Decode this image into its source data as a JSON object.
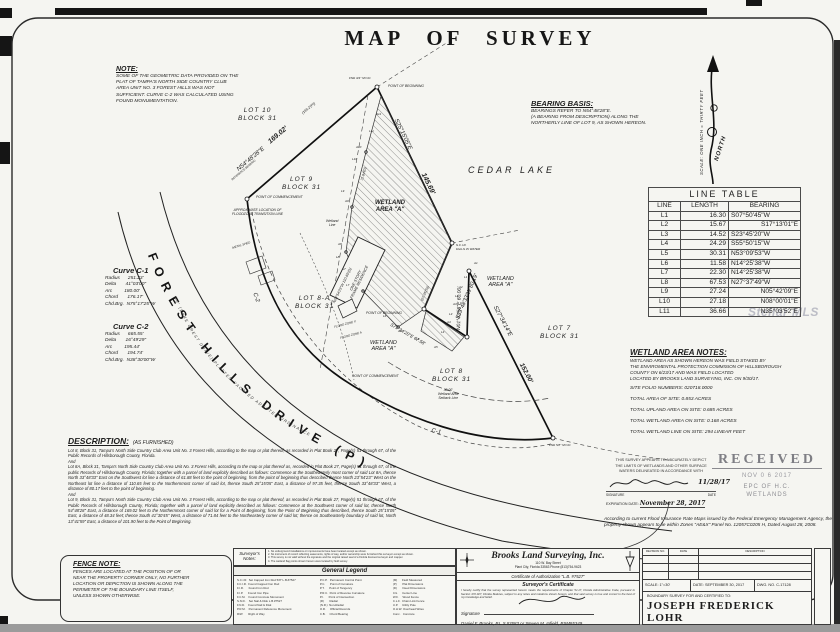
{
  "title": "MAP OF SURVEY",
  "watermark": "Stellar MLS",
  "note": {
    "heading": "NOTE:",
    "body": "SOME OF THE GEOMETRIC DATA PROVIDED ON THE\nPLAT OF TAMPA'S NORTH SIDE COUNTRY CLUB\nAREA UNIT NO. 3 FOREST HILLS WAS NOT\nSUFFICIENT. CURVE C-2 WAS CALCULATED USING\nFOUND MONUMENTATION."
  },
  "bearing_basis": {
    "heading": "BEARING BASIS:",
    "body": "BEARINGS REFER TO N54°48'28\"E.\n(A BEARING FROM DESCRIPTION) ALONG THE\nNORTHERLY LINE OF LOT 9, AS SHOWN HEREON."
  },
  "north": {
    "label": "NORTH",
    "scale": "SCALE: ONE INCH = THIRTY FEET"
  },
  "line_table": {
    "title": "LINE TABLE",
    "headers": [
      "LINE",
      "LENGTH",
      "BEARING"
    ],
    "rows": [
      [
        "L1",
        "16.30",
        "S07°50'45\"W"
      ],
      [
        "L2",
        "15.67",
        "S17°13'01\"E"
      ],
      [
        "L3",
        "14.52",
        "S23°45'20\"W"
      ],
      [
        "L4",
        "24.29",
        "S55°50'15\"W"
      ],
      [
        "L5",
        "30.31",
        "N53°09'53\"W"
      ],
      [
        "L6",
        "11.58",
        "N14°25'38\"W"
      ],
      [
        "L7",
        "22.30",
        "N14°25'38\"W"
      ],
      [
        "L8",
        "67.53",
        "N27°37'49\"W"
      ],
      [
        "L9",
        "27.24",
        "N05°42'09\"E"
      ],
      [
        "L10",
        "27.18",
        "N08°00'01\"E"
      ],
      [
        "L11",
        "36.66",
        "N35°03'52\"E"
      ]
    ]
  },
  "curves": [
    {
      "title": "Curve   C-1",
      "body": "Radius      251.23'\nDelta       41°03'00\"\nArc         180.00'\nChord       176.17'\nChd.Brg.  N75°17'25\"W"
    },
    {
      "title": "Curve   C-2",
      "body": "Radius      665.55'\nDelta       16°49'29\"\nArc         195.44'\nChord       194.74'\nChd.Brg.  N38°30'00\"W"
    }
  ],
  "wetland_notes": {
    "heading": "WETLAND AREA NOTES:",
    "body": "WETLAND AREA AS SHOWN HEREON WAS FIELD STAKED BY\nTHE ENVIROMENTAL PROTECTION COMMISION OF HILLSBOROUGH\nCOUNTY ON 6/23/17 AND WAS FIELD LOCATED\nLOCATED BY BROOKS LAND SURVEYING, INC. ON 9/30/17.",
    "stats": "SITE FOLIO NUMBERS:   020718.0000\n\nTOTAL AREA OF SITE: 0.853 ACRES\n\nTOTAL UPLAND AREA ON SITE: 0.685 ACRES\n\nTOTAL WETLAND AREA ON SITE: 0.168 ACRES\n\nTOTAL WETLAND LINE ON SITE: 294 LINEAR FEET"
  },
  "certification": {
    "body": "THIS SURVEY APPEARS TO ACCURATELY DEPICT\nTHE LIMITS OF WETLANDS AND OTHER SURFACE\nWATERS DELINEATED IN ACCORDANCE WITH",
    "sig_date": "11/28/17",
    "sig_label": "SIGNATURE",
    "date_label": "DATE",
    "exp_label": "EXPIRATION DATE:",
    "exp_value": "November 28, 2017"
  },
  "received": {
    "title": "RECEIVED",
    "date": "NOV 0 6 2017",
    "org": "EPC OF H.C.",
    "dept": "WETLANDS"
  },
  "flood_note": "According to current Flood Insurance Rate Maps issued by the Federal Emergency Management Agency, the property shown appears to lie within Zones \"AE&X\" Panel No. 12057C0205 H, Dated August 28, 2008.",
  "description": {
    "heading": "DESCRIPTION:",
    "subheading": "(AS FURNISHED)",
    "para1": "Lot 8, Block 31, Tampa's North Side Country Club Area Unit No. 3 Forest Hills, according to the map or plat thereof, as recorded in Plat Book 27, Page(s) 51 through 67, of the Public Records of Hillsborough County, Florida.",
    "and": "And",
    "para2": "Lot 8A, Block 31, Tampa's North Side Country Club Area Unit No. 3 Forest Hills, according to the map or plat thereof as, recorded in Plat Book 27, Page(s) 51 through 67, of the public Records of Hillsborough County, Florida; together with a parcel of land explicitly described as follows: Commence at the Southeasterly most corner of said Lot 8A, thence North 33°48'33\" East on the Southwest lot line a distance of 61.88 feet to the point of beginning, from the point of beginning thus described thence North 23°54'23\" West on the Northeast lot line a distance of 110.65 feet to the Northernmost corner of said lot, thence South 25°15'05\" East, a distance of 97.35 feet, thence South 33°48'33\" West, a distance of 80.17 feet to the point of beginning.",
    "para3": "Lot 9, Block 31, Tampa's North Side Country Club Area Unit No. 3 Forest Hills, according to the map or plat thereof, as recorded in Plat Book 27, Page(s) 51 through 67, of the Public Records of Hillsborough County, Florida; together with a parcel of land explicitly described as follows: Commence at the Southwest corner of said lot, thence North 54°48'28\" East, a distance of 169.02 feet to the Northernmost corner of said lot for a Point of Beginning; from the Point of Beginning thus described, thence South 25°15'05\" East, a distance of 48.34 feet; thence South 41°30'45\" West, a distance of 71.84 feet to the Northeasterly corner of said lot; thence on Southeasterly boundary of said lot, North 13°41'59\" East, a distance of 101.90 feet to the Point of Beginning."
  },
  "fence_note": {
    "heading": "FENCE NOTE:",
    "body": "FENCES ARE LOCATED AT THE POSITION OF OR\nNEAR THE PROPERTY CORNER ONLY, NO FURTHER\nLOCATION OR DEPICTION IS SHOWN ALONG THE\nPERIMETER OF THE BOUNDARY LINE ITSELF,\nUNLESS SHOWN OTHERWISE."
  },
  "surveyor_notes": {
    "label": "Surveyor's\nNotes:",
    "body": "1. No underground installations or improvements have been located except as shown.\n2. No instrument of record reflecting easements, rights of way, and/or ownership were furnished this surveyor except as shown.\n3. This survey is not valid without the signature and the original raised seal of a Florida licensed surveyor and mapper.\n4. The wetland flag points shown hereon were located by field survey."
  },
  "legend": {
    "title": "General Legend",
    "col1": "S.C.I.R.  Set Capped Iron Rod 5/8\" L.B.#7527\nF.C.I.R.  Found Capped Iron Rod\nF.I.R.      Found Iron Rod\nF.I.P.      Found Iron Pipe\nF.C.M.    Found Concrete Monument\nS.N.D.    Set Nail & Disk L.B.#7527\nF.N.D.    Found Nail & Disk\nP.R.M.    Permanent Reference Monument\nR/W       Right of Way",
    "col2": "P.C.P.   Permanent Control Point\nP.C.      Point of Curvature\nP.T.      Point of Tangency\nP.R.C.  Point of Reverse Curvature\nP.I.      Point of Intersection\n(R)       Radial\n(N.R.)  Non-Radial\nO.R.     Official Records\nC.B.     Chord Bearing",
    "col3": "(M)      Field Measured\n(P)       Plat Dimensions\n(D)       Deed Dimensions\nC/L      Center Line\nW.F.     Wood Fence\nC.L.F.  Chain Link Fence\nU.P.     Utility Pole\nO.H.W. Overhead Wires\nConc.   Concrete"
  },
  "firm": {
    "name": "Brooks Land Surveying, Inc.",
    "address1": "110 W. Bay Street",
    "address2": "Plant City, Florida 33563    Phone (813)754-9623",
    "auth": "Certificate  of  Authorization  \"L.B. #7527\"",
    "cert_title": "Surveyor's Certificate",
    "cert_body": "I hereby certify that the survey represented hereon meets the requirements of Chapter 5J-17, Florida Administrative Code, pursuant to Section 472.027, Florida Statutes, subject to any notes and notations shown hereon, and that said survey is true and correct to the best of my knowledge and belief.",
    "sig_label": "Signature",
    "signers": "Daniel F. Brooks, P.L.S.#3583 or Steven M. Infield, PSM#5349"
  },
  "title_block": {
    "rev_no": "REVISION NO.",
    "rev_date": "DATE",
    "rev_desc": "DESCRIPTION",
    "scale": "SCALE:  1\"=30'",
    "date": "DATE:  SEPTEMBER 30, 2017",
    "dwg": "DWG. NO. C-17128",
    "certified_label": "BOUNDARY SURVEY FOR AND CERTIFIED TO:",
    "certified_to": "JOSEPH FREDERICK LOHR"
  },
  "map": {
    "labels": {
      "lot10": "LOT 10\nBLOCK 31",
      "lot9": "LOT 9\nBLOCK 31",
      "lot8a": "LOT 8-A\nBLOCK 31",
      "lot8": "LOT 8\nBLOCK 31",
      "lot7": "LOT 7\nBLOCK 31",
      "cedar_lake": "CEDAR LAKE",
      "wetland_a": "WETLAND\nAREA  \"A\"",
      "road": "FOREST HILLS DRIVE (P)",
      "vacated": "60' (LAKE CREST DRIVE) PLATTED VACATED ADOPTED ORDINANCE",
      "c1": "C-1",
      "c2": "C-2",
      "brg_ne": "N54°48'28\"E",
      "ref_bearing": "REFERENCE BEARING",
      "dist_169": "169.02'",
      "dist_169p": "(169.2'(P))",
      "brg_se": "S25°15'05\"E",
      "dist_145": "145.69'",
      "brg_80": "S33°48'33\"W  80.19'",
      "dist_97": "(97.35'(D))",
      "brg_67": "S71°34'20\"E  67.58'",
      "brg_60": "N01°42'56\"E  60.00'",
      "brg_152": "S27°34'14\"E",
      "dist_152": "152.00'",
      "brg_110": "N23°54'23\"W 110.65'(D)",
      "dist_7184": "71.84'(D)",
      "poc": "POINT OF COMMENCEMENT",
      "pob": "POINT OF BEGINNING",
      "fnd34": "FND 3/4\" NO ID",
      "fnd58": "FND 5/8\" NO ID",
      "scir_water": "S.C.I.R.\nFALLS IN WATER",
      "approx_flood": "APPROXIMATE LOCATION OF\nFLOODZONE TRANSITION LINE",
      "wetland_line": "Wetland\nLine",
      "setback": "30.00'\nWetland Area\nSetback Line",
      "flood_x": "FLOOD ZONE X",
      "flood_a": "FLOOD ZONE A",
      "residence": "ONE STORY\nFRAME RESIDENCE",
      "metal_shed": "METAL SHED"
    },
    "aflags": [
      "A1",
      "A2",
      "A3",
      "A4",
      "A5",
      "A6",
      "A7",
      "A8",
      "A9",
      "A10",
      "A11"
    ],
    "lflags": [
      "L1",
      "L2",
      "L3",
      "L4",
      "L5",
      "L6",
      "L7",
      "L8",
      "L9",
      "L10",
      "L11"
    ]
  }
}
